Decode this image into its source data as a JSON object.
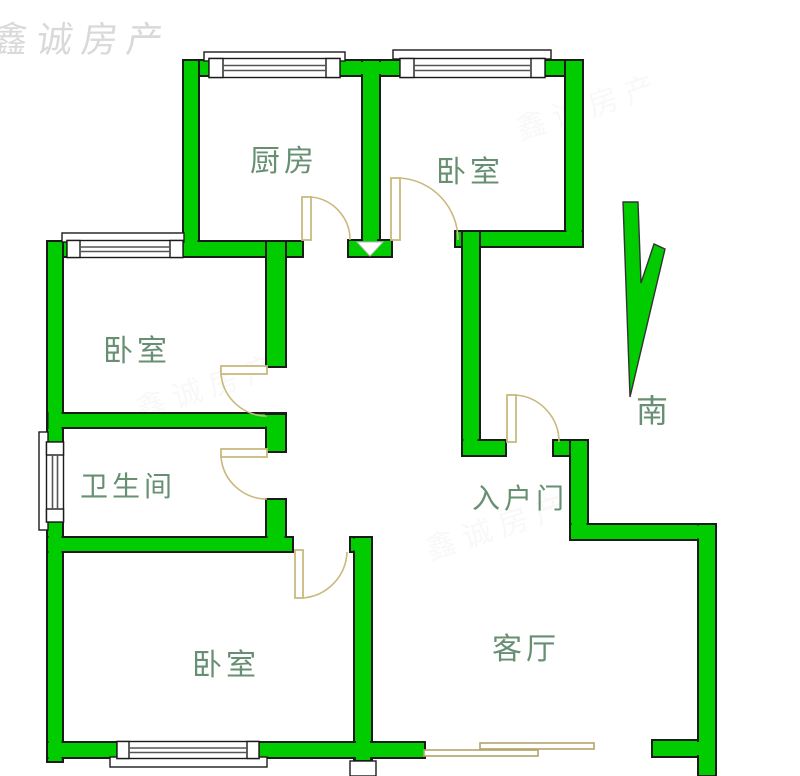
{
  "watermark": {
    "text": "鑫诚房产"
  },
  "compass": {
    "label": "南",
    "direction": "south"
  },
  "rooms": [
    {
      "id": "kitchen",
      "label": "厨房"
    },
    {
      "id": "bedroom-top-right",
      "label": "卧室"
    },
    {
      "id": "bedroom-middle-left",
      "label": "卧室"
    },
    {
      "id": "bathroom",
      "label": "卫生间"
    },
    {
      "id": "bedroom-bottom-left",
      "label": "卧室"
    },
    {
      "id": "living-room",
      "label": "客厅"
    },
    {
      "id": "entry-door",
      "label": "入户门"
    }
  ],
  "colors": {
    "wall_fill": "#00cc00",
    "wall_outline": "#1b1b1b",
    "door_swing": "#c9b97e",
    "label_text": "#678f72",
    "watermark_text": "#8a8a8a",
    "background": "#ffffff"
  }
}
